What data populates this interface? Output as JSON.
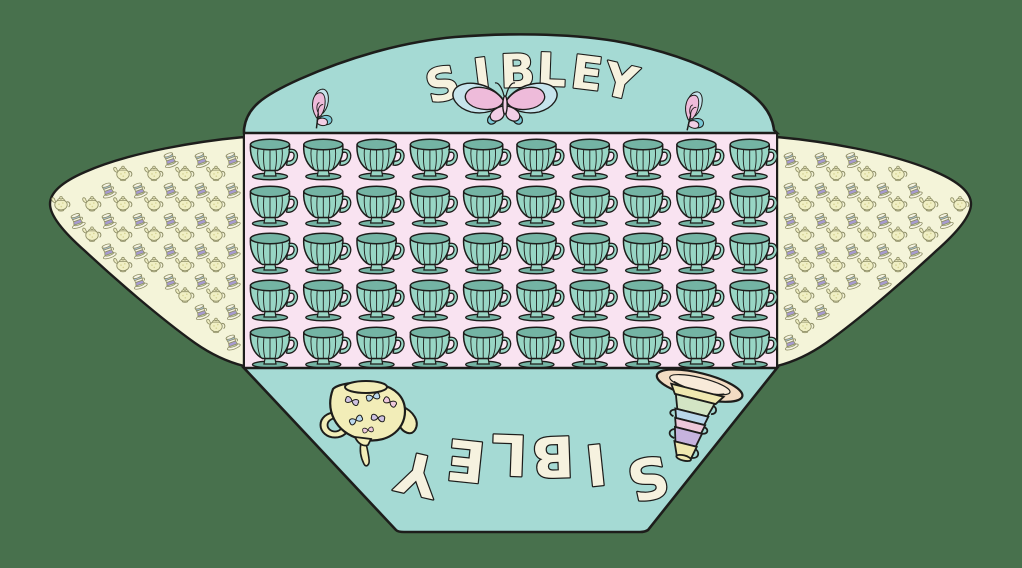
{
  "canvas": {
    "width": 1022,
    "height": 568,
    "background": "#48714d"
  },
  "envelope": {
    "title_top": "SIBLEY",
    "title_bottom": "SIBLEY",
    "title_bottom_orientation": "upside-down",
    "colors": {
      "outline": "#1d1d1b",
      "flap_teal": "#a5dad4",
      "panel_pink": "#f9e3f1",
      "flap_cream": "#f4f4d9",
      "cup_light": "#98d6c5",
      "cup_dark": "#74b4a4",
      "title_cream": "#f6f2df",
      "butterfly_pink": "#eebbda",
      "butterfly_pink_light": "#f2cfe6",
      "butterfly_blue": "#c6e4ec",
      "butterfly_teal": "#79c8d6",
      "motif_outline": "#8e8e66",
      "motif_yellow": "#f0efc4",
      "motif_dot": "#d6d494",
      "motif_purple": "#a79bd1",
      "motif_blue": "#a8c4e2",
      "motif_white": "#f6f4e4",
      "motif_green": "#cfe0b4",
      "teapot_body": "#f2edb8",
      "deco_lavender": "#cfc2e2",
      "deco_blue": "#bcd9ee",
      "deco_pink": "#eec8dc",
      "plate_peach": "#f3dcc3",
      "plate_inner": "#f8ead9",
      "stack_yellow": "#efe8b0",
      "stack_green": "#d3e5c4",
      "stack_blue": "#b9d7ea",
      "stack_pink": "#ecc8da",
      "stack_purple": "#c6b3de"
    },
    "top_flap": {
      "decorations": [
        "butterfly-small-left",
        "butterfly-large-center",
        "butterfly-small-right",
        "title-top"
      ]
    },
    "body_panel": {
      "grid": {
        "motif": "teacup",
        "columns": 10,
        "rows": 5,
        "count": 50
      }
    },
    "side_flap_left": {
      "pattern_motifs": [
        "teapot",
        "stacked-teacups"
      ]
    },
    "side_flap_right": {
      "pattern_motifs": [
        "teapot",
        "stacked-teacups"
      ]
    },
    "bottom_flap": {
      "decorations": [
        "pouring-teapot",
        "stacked-teacups-on-plate",
        "title-bottom-upside-down"
      ]
    }
  }
}
